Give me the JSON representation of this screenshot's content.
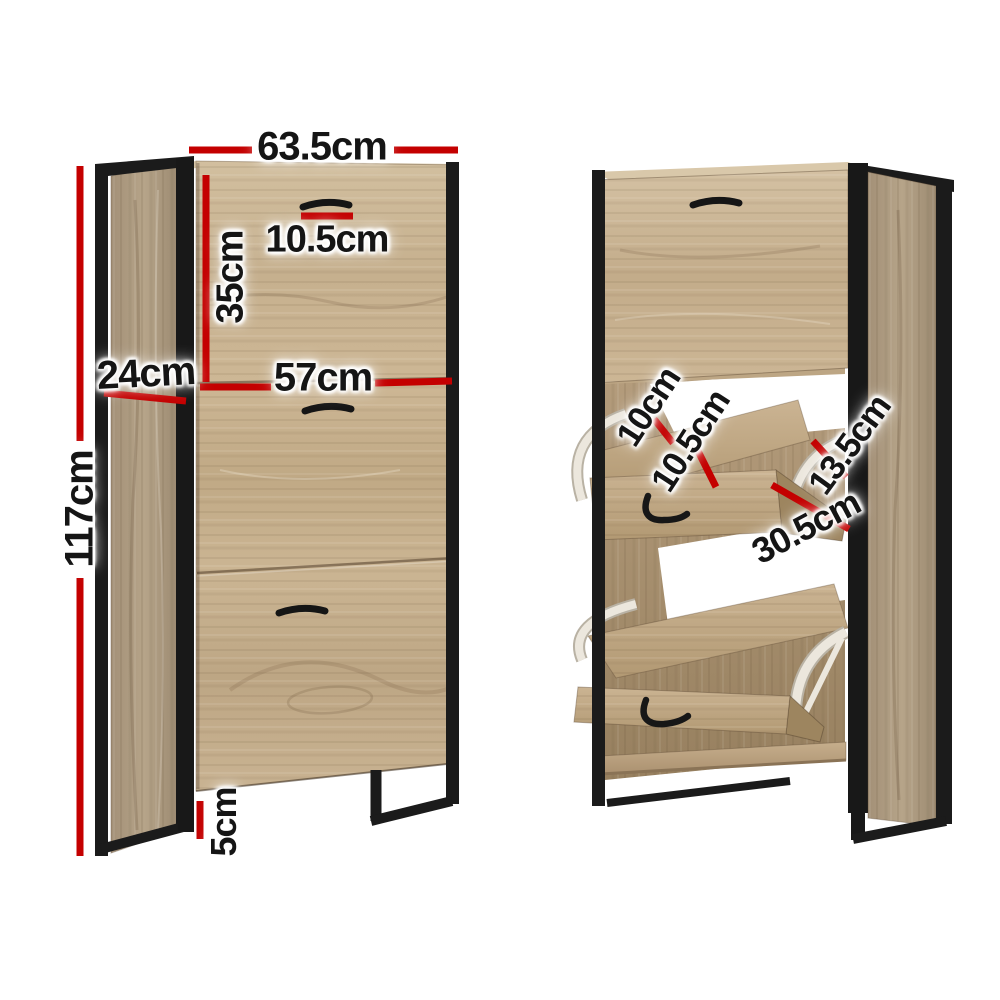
{
  "colors": {
    "dimension_line": "#c40000",
    "label_text": "#151515",
    "wood_light": "#c8b292",
    "wood_side": "#ab977c",
    "wood_interior": "#a48c6c",
    "metal_frame": "#1b1b1b",
    "hinge_white": "#ece7dd",
    "background": "#ffffff"
  },
  "front_view": {
    "width_label": "63.5cm",
    "handle_width_label": "10.5cm",
    "top_door_height_label": "35cm",
    "depth_label": "24cm",
    "door_width_label": "57cm",
    "height_label": "117cm",
    "leg_height_label": "5cm"
  },
  "open_view": {
    "shelf_gap_label": "10cm",
    "shelf_depth_label": "10.5cm",
    "flap_opening_label": "13.5cm",
    "flap_panel_label": "30.5cm"
  }
}
